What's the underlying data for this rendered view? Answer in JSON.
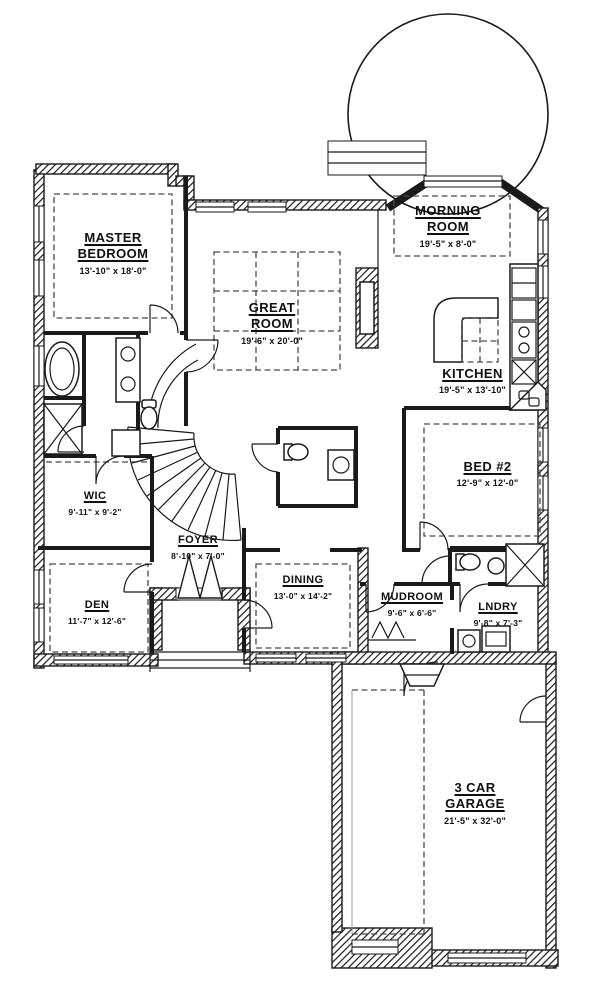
{
  "colors": {
    "ink": "#1a1a1a",
    "background": "#ffffff",
    "dash": "#4a4a4a"
  },
  "rooms": [
    {
      "id": "master-bedroom",
      "name_lines": [
        "MASTER",
        "BEDROOM"
      ],
      "dims": "13'-10\" x 18'-0\""
    },
    {
      "id": "great-room",
      "name_lines": [
        "GREAT",
        "ROOM"
      ],
      "dims": "19'-6\" x 20'-0\""
    },
    {
      "id": "morning-room",
      "name_lines": [
        "MORNING",
        "ROOM"
      ],
      "dims": "19'-5\" x 8'-0\""
    },
    {
      "id": "kitchen",
      "name_lines": [
        "KITCHEN"
      ],
      "dims": "19'-5\" x 13'-10\""
    },
    {
      "id": "bed-2",
      "name_lines": [
        "BED #2"
      ],
      "dims": "12'-9\" x 12'-0\""
    },
    {
      "id": "wic",
      "name_lines": [
        "WIC"
      ],
      "dims": "9'-11\" x 9'-2\""
    },
    {
      "id": "foyer",
      "name_lines": [
        "FOYER"
      ],
      "dims": "8'-10\" x 7'-0\""
    },
    {
      "id": "dining",
      "name_lines": [
        "DINING"
      ],
      "dims": "13'-0\" x 14'-2\""
    },
    {
      "id": "den",
      "name_lines": [
        "DEN"
      ],
      "dims": "11'-7\" x 12'-6\""
    },
    {
      "id": "mudroom",
      "name_lines": [
        "MUDROOM"
      ],
      "dims": "9'-6\" x 6'-6\""
    },
    {
      "id": "laundry",
      "name_lines": [
        "LNDRY"
      ],
      "dims": "9'-8\" x 7'-3\""
    },
    {
      "id": "garage",
      "name_lines": [
        "3 CAR",
        "GARAGE"
      ],
      "dims": "21'-5\" x 32'-0\""
    }
  ]
}
